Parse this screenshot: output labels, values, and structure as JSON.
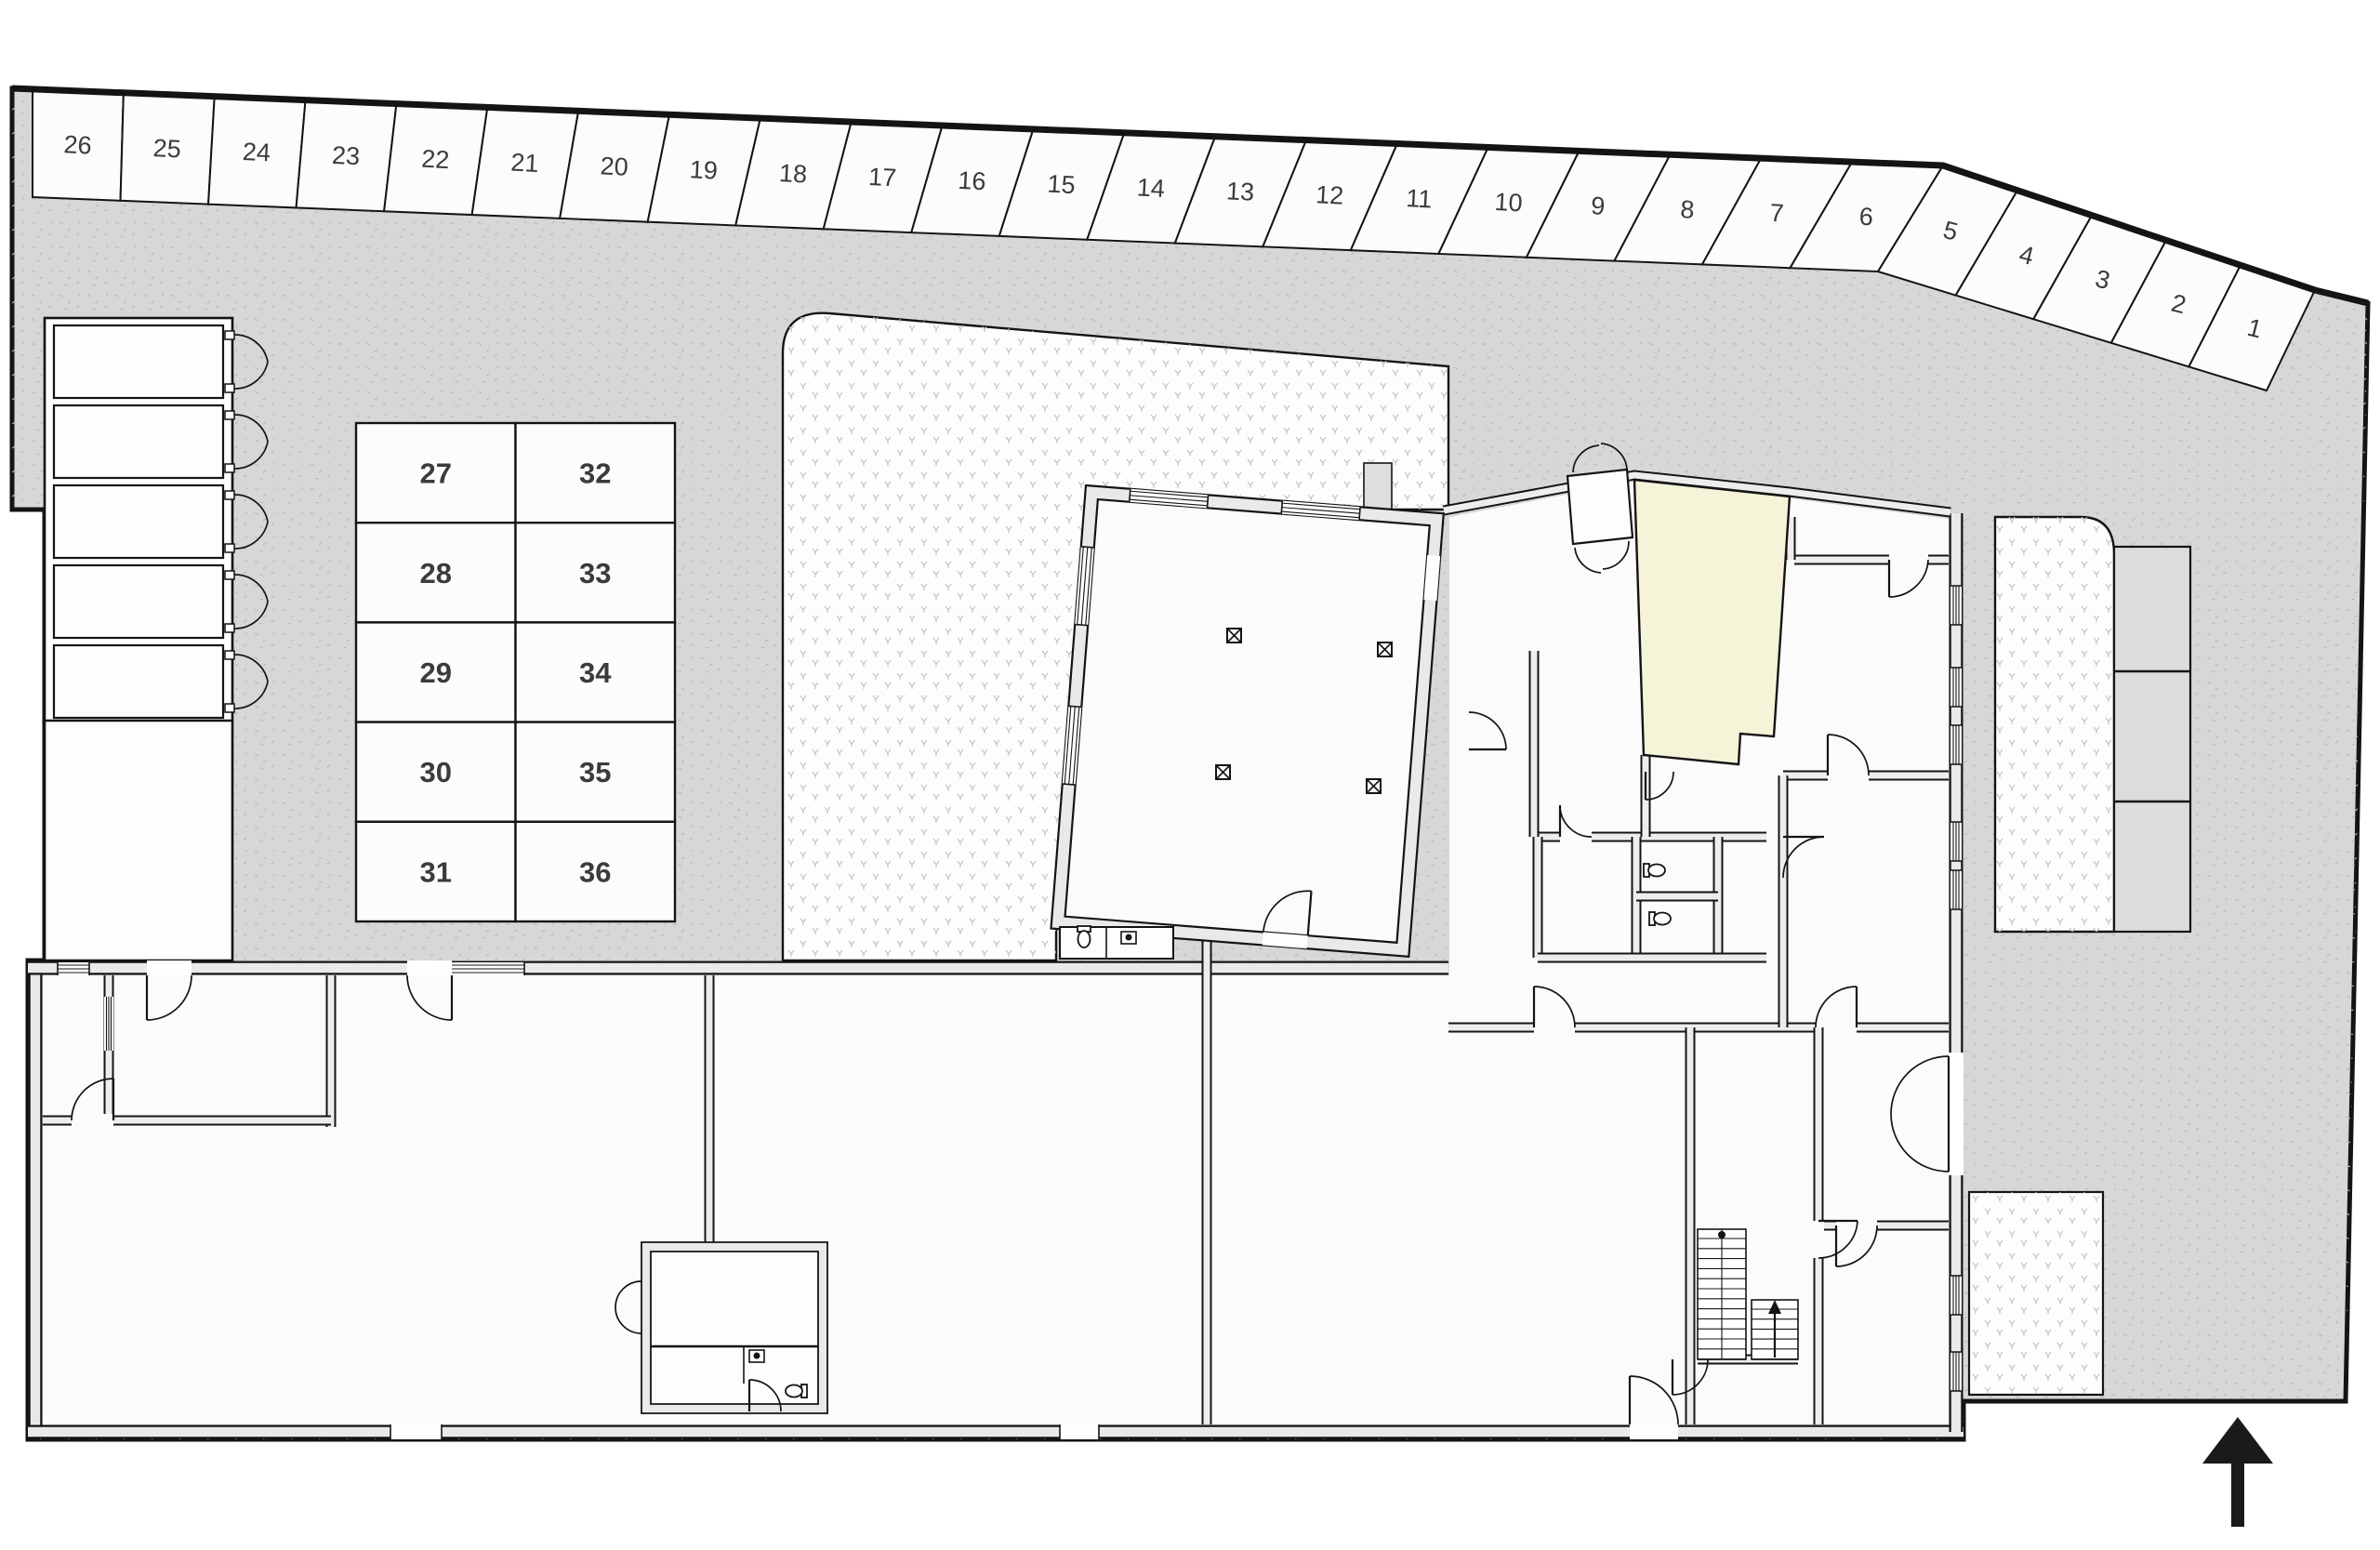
{
  "plan": {
    "kind": "architectural site / ground-floor plan",
    "colors": {
      "site": "#d7d7d7",
      "paving": "#fdfdfd",
      "wall_fill": "#e9e9e9",
      "room_fill": "#fbfbfb",
      "stall_fill": "#fcfcfc",
      "highlight_room": "#f5f3d8",
      "panel": "#dcdcdc",
      "line": "#141414",
      "number": "#3b3b3b"
    },
    "parking_row": {
      "numbers": [
        "26",
        "25",
        "24",
        "23",
        "22",
        "21",
        "20",
        "19",
        "18",
        "17",
        "16",
        "15",
        "14",
        "13",
        "12",
        "11",
        "10",
        "9",
        "8",
        "7",
        "6",
        "5",
        "4",
        "3",
        "2",
        "1"
      ]
    },
    "parking_grid": {
      "columns": [
        [
          "27",
          "28",
          "29",
          "30",
          "31"
        ],
        [
          "32",
          "33",
          "34",
          "35",
          "36"
        ]
      ]
    },
    "garages": {
      "count": 5
    },
    "symbols": {
      "north_arrow": "north-arrow pointing up",
      "column_marker": "column (boxed X)",
      "toilet": "WC toilet",
      "sink": "wash basin",
      "stairs": "staircase with up arrow"
    }
  }
}
